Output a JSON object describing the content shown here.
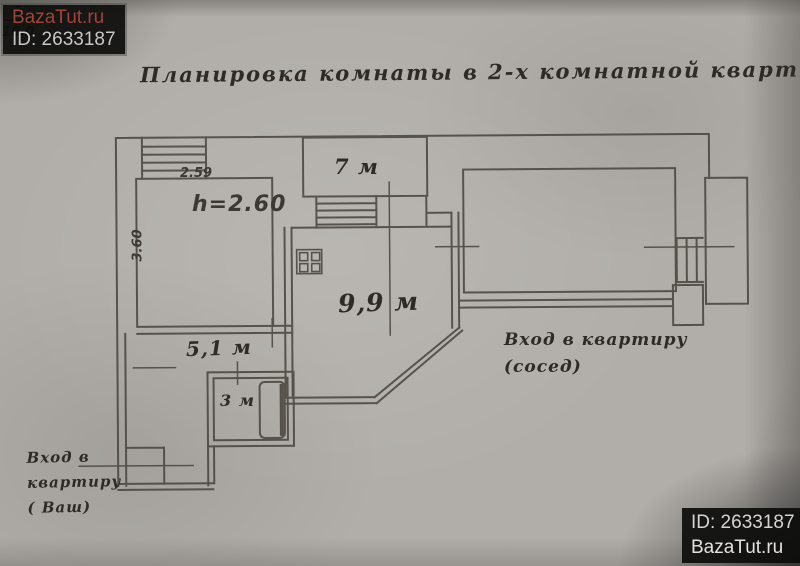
{
  "title": "Планировка комнаты в 2-х комнатной квартире",
  "watermarks": {
    "top_left": {
      "site": "BazaTut.ru",
      "id": "ID: 2633187"
    },
    "bottom_right": {
      "id": "ID: 2633187",
      "site": "BazaTut.ru"
    }
  },
  "plan": {
    "room1": {
      "number": "1",
      "area": "10.0",
      "width": "2.59",
      "depth": "3.60",
      "ceiling_height": "h=2.60"
    },
    "balcony": {
      "area": "7 м"
    },
    "kitchen": {
      "area": "9,9 м"
    },
    "hallway": {
      "area": "5,1 м"
    },
    "bathroom": {
      "area": "3 м"
    },
    "entrance_neighbor": {
      "line1": "Вход в квартиру",
      "line2": "(сосед)"
    },
    "entrance_own": {
      "line1": "Вход в",
      "line2": "квартиру",
      "line3": "( Ваш)"
    }
  },
  "colors": {
    "paper": "#b1aea9",
    "ink": "#4a453f",
    "watermark_site_red": "#a2423a",
    "watermark_bg": "#0c0c0b"
  }
}
